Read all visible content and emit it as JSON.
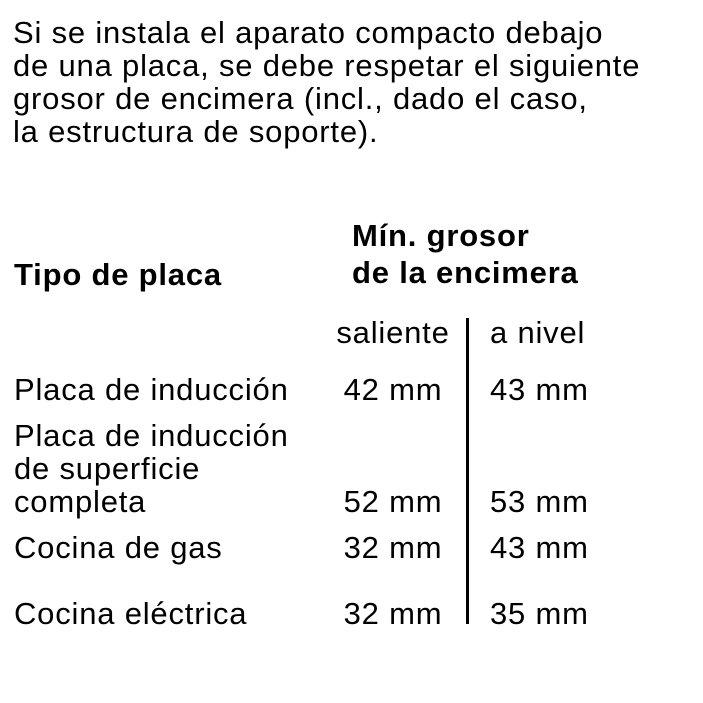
{
  "page": {
    "background": "#ffffff",
    "text_color": "#000000"
  },
  "intro_paragraph": {
    "lines": [
      "Si se instala el aparato compacto debajo",
      "de una placa, se debe respetar el siguiente",
      "grosor de encimera (incl., dado el caso,",
      "la estructura de soporte)."
    ]
  },
  "table": {
    "col1_header": "Tipo de placa",
    "col2_header_lines": [
      "Mín. grosor",
      "de la encimera"
    ],
    "subheaders": {
      "saliente": "saliente",
      "a_nivel": "a nivel"
    },
    "rows": [
      {
        "label_lines": [
          "Placa de inducción"
        ],
        "saliente": "42 mm",
        "a_nivel": "43 mm"
      },
      {
        "label_lines": [
          "Placa de inducción",
          "de superficie",
          "completa"
        ],
        "saliente": "52 mm",
        "a_nivel": "53 mm"
      },
      {
        "label_lines": [
          "Cocina de gas"
        ],
        "saliente": "32 mm",
        "a_nivel": "43 mm"
      },
      {
        "label_lines": [
          "Cocina eléctrica"
        ],
        "saliente": "32 mm",
        "a_nivel": "35 mm"
      }
    ]
  }
}
